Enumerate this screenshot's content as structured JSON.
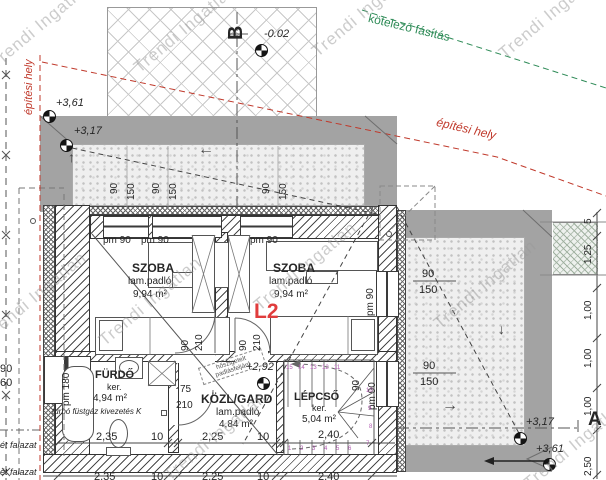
{
  "watermark": "Trendi Ingatlan",
  "site": {
    "building_line_label": "építési hely",
    "tree_line_label": "kötelező fásítás"
  },
  "section_markers": {
    "b": "B",
    "a": "A"
  },
  "floor_label": "L2",
  "elevations": {
    "terrace_top": "-0.02",
    "parapet_left_top": "+3,61",
    "terrace_left": "+3,17",
    "attic_access": "+2,92",
    "terrace_right": "+3,17",
    "parapet_right_bottom": "+3,61"
  },
  "rooms": {
    "bedroom_left": {
      "name": "SZOBA",
      "floor": "lam.padló",
      "area": "9,94 m²"
    },
    "bedroom_right": {
      "name": "SZOBA",
      "floor": "lam.padló",
      "area": "9,94 m²"
    },
    "bathroom": {
      "name": "FÜRDŐ",
      "floor": "ker.",
      "area": "4,94 m²",
      "flue_note": "turbó füstgáz kivezetés K"
    },
    "hallway": {
      "name": "KÖZL/GARD",
      "floor": "lam.padló",
      "area": "4,84 m²",
      "attic_note_line1": "hőszigetelt",
      "attic_note_line2": "padlásfeljáró"
    },
    "staircase": {
      "name": "LÉPCSŐ",
      "floor": "ker.",
      "area": "5,04 m²"
    }
  },
  "openings": {
    "sill_90": "pm 90",
    "sill_180": "pm 180",
    "window_width": "90",
    "window_height": "150",
    "door_width": "90",
    "door_height": "210",
    "bath_door_width": "75"
  },
  "dimensions": {
    "bath_width": "2,35",
    "partition_thickness": "10",
    "hall_width": "2,25",
    "stair_width": "2,40",
    "right_chain": [
      "5",
      "1,25",
      "1,00",
      "1,00",
      "1,00",
      "2,50"
    ],
    "left_margin_cut": [
      "90",
      "60",
      "ét falazat",
      "ét falazat"
    ]
  },
  "stairs": {
    "upper_run_steps": [
      "15",
      "14",
      "13",
      "12",
      "11"
    ],
    "winder_steps": [
      "10",
      "9",
      "8",
      "7"
    ],
    "lower_run_steps": [
      "1",
      "2",
      "3",
      "4",
      "5",
      "6"
    ]
  },
  "colors": {
    "building_line": "#c0392b",
    "tree_line": "#2e8b57",
    "step_numbers": "#b05ab0",
    "parapet_gray": "#a3a3a3",
    "floor_label_red": "#e03c3c"
  }
}
